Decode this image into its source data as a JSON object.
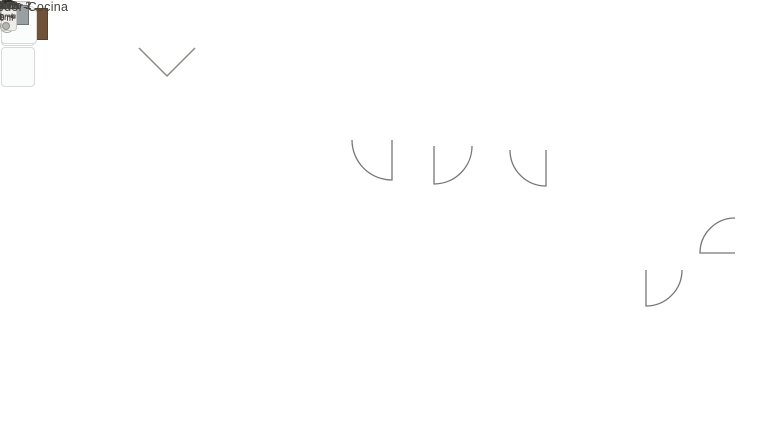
{
  "plan_labels": {
    "lv": "LV",
    "ae": "AE"
  },
  "rooms": {
    "terraza": {
      "name": "Terraza",
      "area": "17,79 m²"
    },
    "dormitorio1": {
      "name": "Dormitorio 1",
      "area": "12,05 m²"
    },
    "bano1": {
      "name": "Baño 1",
      "area": "3,80 m²"
    },
    "paso": {
      "name": "Paso",
      "area": "0,95 m²"
    },
    "dormitorio2": {
      "name": "Dormitorio 2",
      "area": "10,80 m²"
    },
    "salon": {
      "name": "Salón-Comedor-Cocina",
      "area": "26,80 m²"
    },
    "entrada": {
      "name": "Entrada",
      "area": "1,90 m²"
    },
    "bano2": {
      "name": "Baño 2",
      "area": "3,70 m²"
    }
  },
  "colors": {
    "wall": "#2d2a27",
    "interior_floor": "#e7e3db",
    "terrace_floor": "#d9d2c7",
    "grass": "#82a269",
    "hedge": "#46603a",
    "wood": "#a78e75",
    "bed1_duvet": "#22395a",
    "tan_paving": "#d9cab1"
  }
}
